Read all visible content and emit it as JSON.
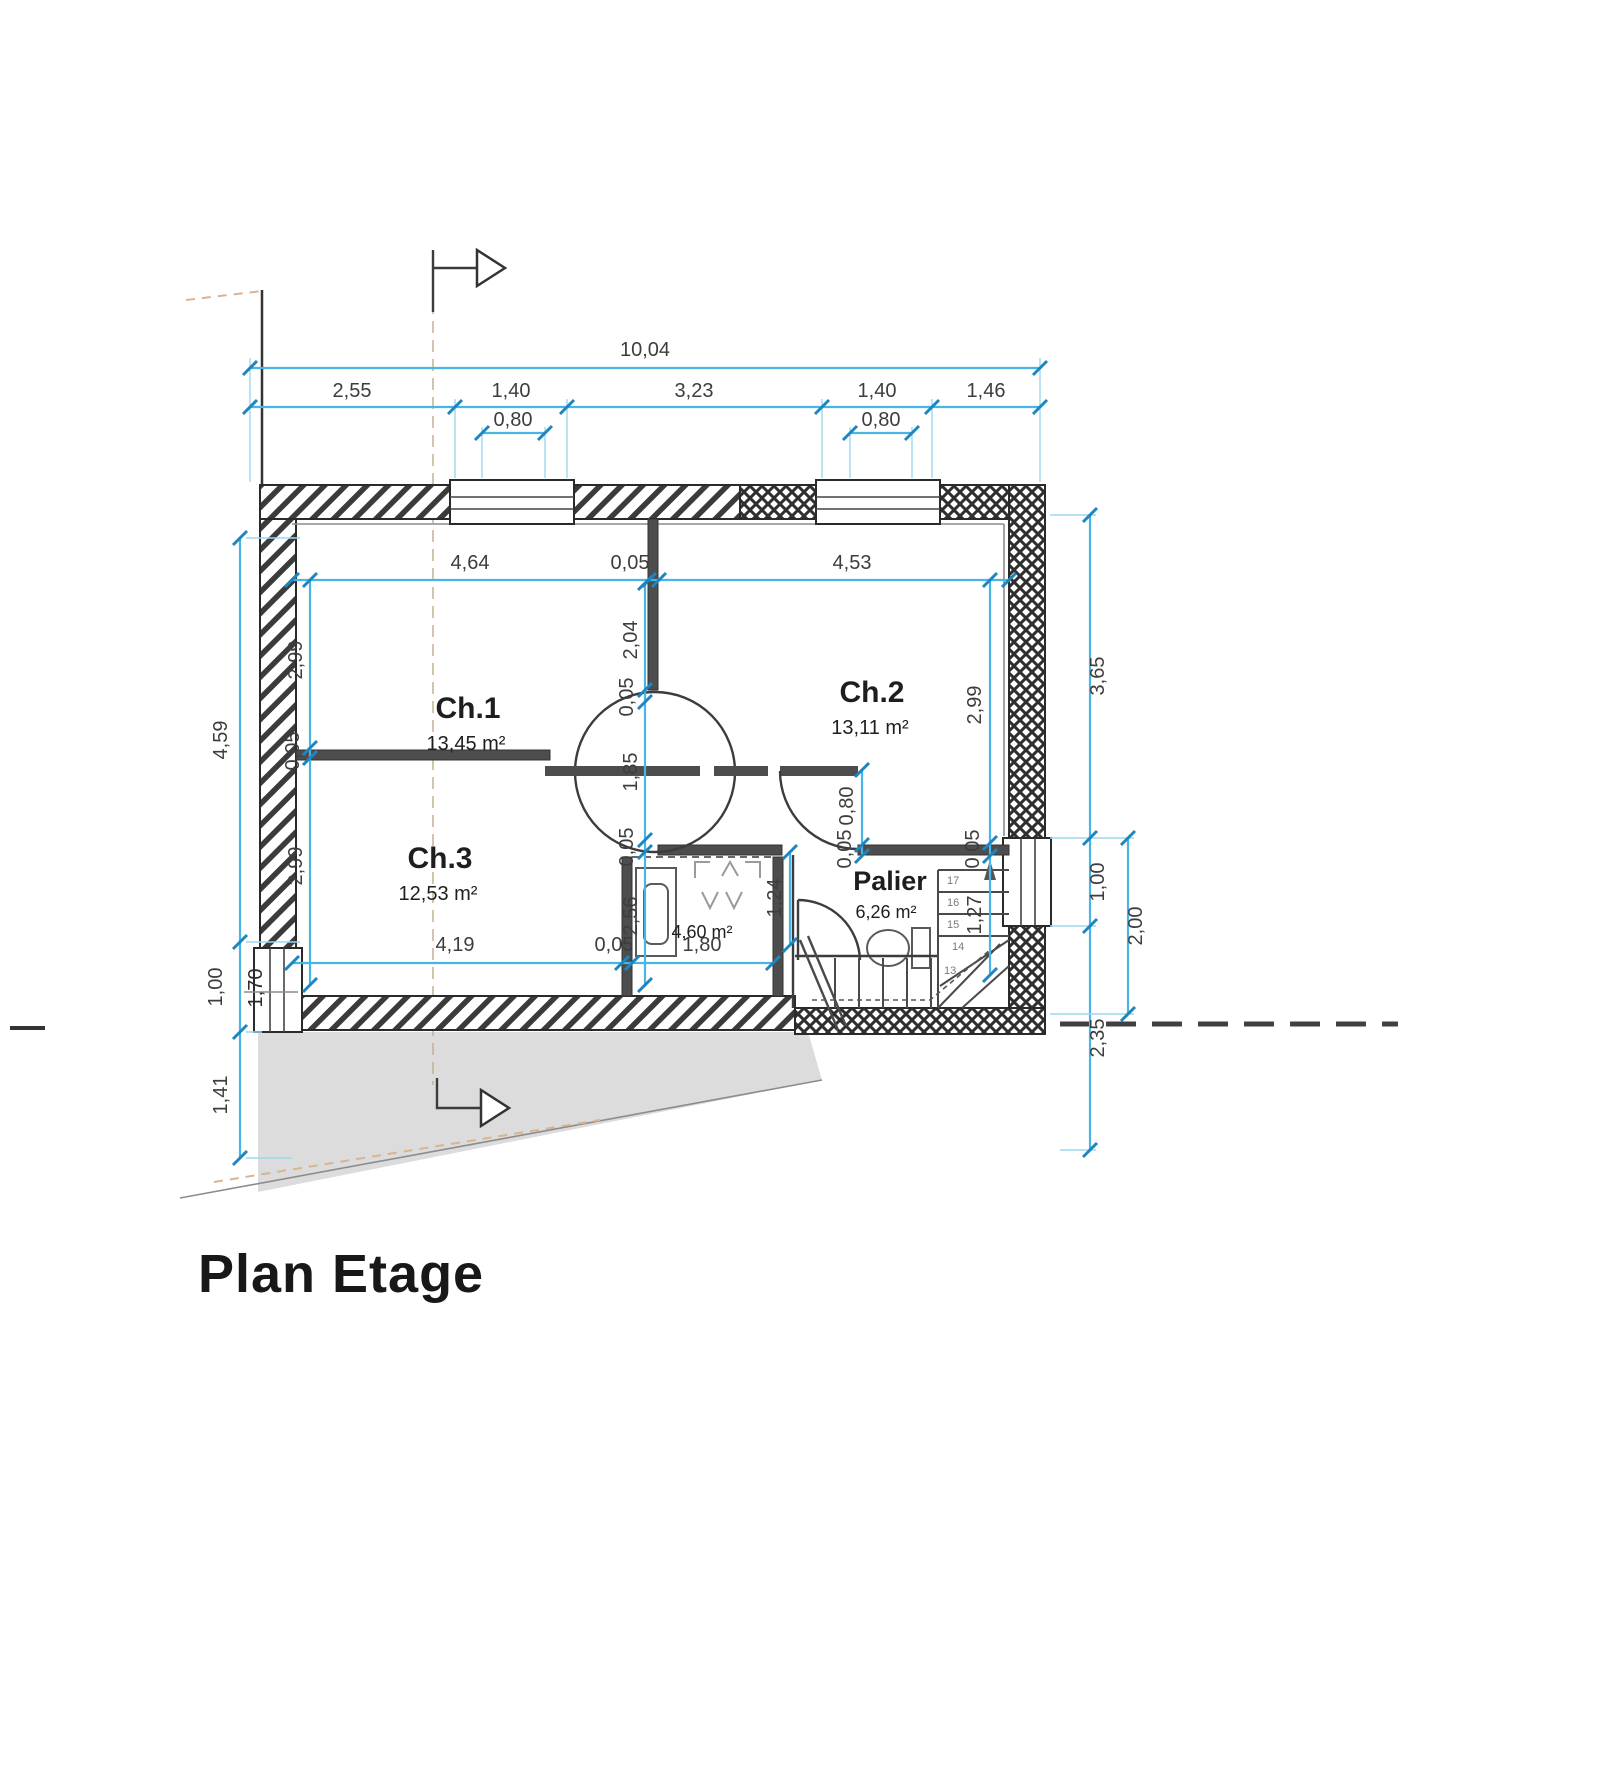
{
  "title": {
    "text": "Plan Etage"
  },
  "rooms": {
    "ch1": {
      "name": "Ch.1",
      "area": "13,45 m²"
    },
    "ch2": {
      "name": "Ch.2",
      "area": "13,11 m²"
    },
    "ch3": {
      "name": "Ch.3",
      "area": "12,53 m²"
    },
    "palier": {
      "name": "Palier",
      "area": "6,26 m²"
    },
    "bath": {
      "area": "4,60 m²"
    }
  },
  "dims": {
    "top": {
      "overall": "10,04",
      "seg1": "2,55",
      "seg2": "1,40",
      "seg3": "3,23",
      "seg4": "1,40",
      "seg5": "1,46",
      "sub1": "0,80",
      "sub2": "0,80"
    },
    "left": {
      "d1": "4,59",
      "d2": "1,00",
      "d3": "1,70",
      "d4": "1,41"
    },
    "right": {
      "inner1": "2,99",
      "inner2": "0,05",
      "inner3": "1,27",
      "mid1": "3,65",
      "mid2": "1,00",
      "mid3": "2,35",
      "outer1": "2,00"
    },
    "inner_top": {
      "d1": "4,64",
      "d2": "0,05",
      "d3": "4,53"
    },
    "inner_left": {
      "d1": "2,99",
      "d2": "0,05",
      "d3": "2,99"
    },
    "center": {
      "d1": "2,04",
      "d2": "0,05",
      "d3": "1,85",
      "d4": "0,05",
      "d5": "2,56"
    },
    "inner_bottom": {
      "d1": "4,19",
      "d2": "0,05",
      "d3": "1,80"
    },
    "bath_right": "1,24",
    "door_ch2": {
      "d1": "0,80",
      "d2": "0,05"
    }
  },
  "stairs": {
    "n13": "13",
    "n14": "14",
    "n15": "15",
    "n16": "16",
    "n17": "17"
  },
  "colors": {
    "dim_line": "#49b5e7",
    "dim_tick": "#1d85bf",
    "dim_text": "#3d3d3d",
    "wall": "#2a2a2a",
    "terrain": "#dcdcdc",
    "axis_tan": "#cdab7e",
    "boundary_dash": "#404040"
  }
}
